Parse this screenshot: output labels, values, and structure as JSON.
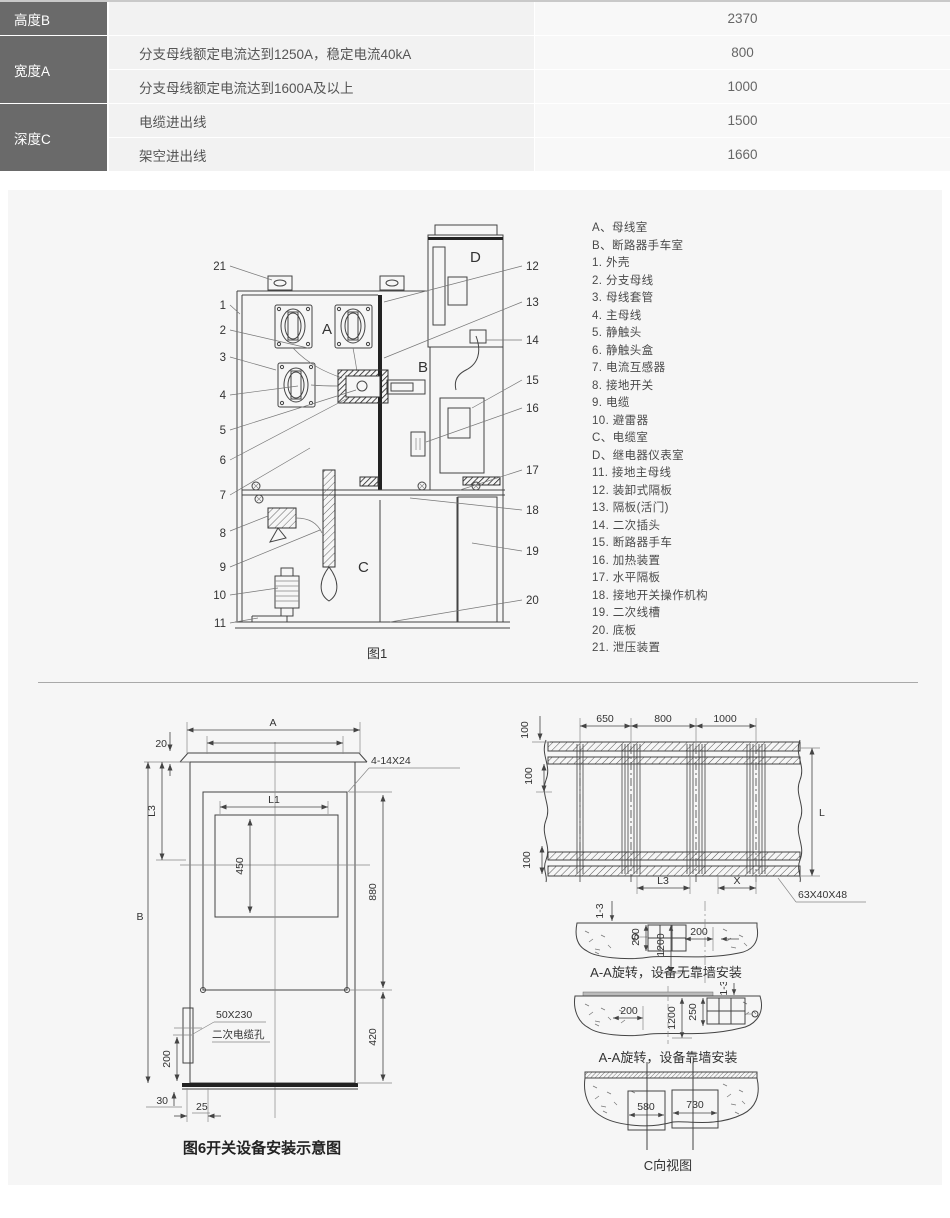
{
  "table": {
    "groups": [
      {
        "header": "高度B",
        "rows": [
          {
            "desc": "",
            "value": "2370"
          }
        ]
      },
      {
        "header": "宽度A",
        "rows": [
          {
            "desc": "分支母线额定电流达到1250A，稳定电流40kA",
            "value": "800"
          },
          {
            "desc": "分支母线额定电流达到1600A及以上",
            "value": "1000"
          }
        ]
      },
      {
        "header": "深度C",
        "rows": [
          {
            "desc": "电缆进出线",
            "value": "1500"
          },
          {
            "desc": "架空进出线",
            "value": "1660"
          }
        ]
      }
    ]
  },
  "legend": {
    "items": [
      "A、母线室",
      "B、断路器手车室",
      "1. 外壳",
      "2. 分支母线",
      "3. 母线套管",
      "4. 主母线",
      "5. 静触头",
      "6. 静触头盒",
      "7. 电流互感器",
      "8. 接地开关",
      "9. 电缆",
      "10. 避雷器",
      "C、电缆室",
      "D、继电器仪表室",
      "11. 接地主母线",
      "12. 装卸式隔板",
      "13. 隔板(活门)",
      "14. 二次插头",
      "15. 断路器手车",
      "16. 加热装置",
      "17. 水平隔板",
      "18. 接地开关操作机构",
      "19. 二次线槽",
      "20. 底板",
      "21. 泄压装置"
    ]
  },
  "fig1": {
    "caption": "图1",
    "rooms": [
      "A",
      "B",
      "C",
      "D"
    ],
    "callouts_left": [
      "21",
      "1",
      "2",
      "3",
      "4",
      "5",
      "6",
      "7",
      "8",
      "9",
      "10",
      "11"
    ],
    "callouts_right": [
      "12",
      "13",
      "14",
      "15",
      "16",
      "17",
      "18",
      "19",
      "20"
    ]
  },
  "fig6": {
    "caption": "图6开关设备安装示意图",
    "dims": {
      "a": "A",
      "l1": "L1",
      "l3": "L3",
      "b": "B",
      "d20": "20",
      "d450": "450",
      "d880": "880",
      "d420": "420",
      "d200": "200",
      "d30": "30",
      "d25": "25",
      "holes": "4-14X24",
      "slot_size": "50X230",
      "slot_name": "二次电缆孔"
    }
  },
  "plan": {
    "dims": {
      "d650": "650",
      "d800": "800",
      "d1000": "1000",
      "d100": "100",
      "l": "L",
      "l3": "L3",
      "x": "X",
      "angle": "63X40X48"
    }
  },
  "s1": {
    "caption": "A-A旋转，设备无靠墙安装",
    "dims": {
      "g13": "1-3",
      "d250": "250",
      "d1200": "1200",
      "d200": "200"
    }
  },
  "s2": {
    "caption": "A-A旋转，设备靠墙安装",
    "dims": {
      "d200": "200",
      "d1200": "1200",
      "d250": "250",
      "g13": "1-3"
    }
  },
  "s3": {
    "caption": "C向视图",
    "dims": {
      "d580": "580",
      "d730": "730"
    }
  }
}
